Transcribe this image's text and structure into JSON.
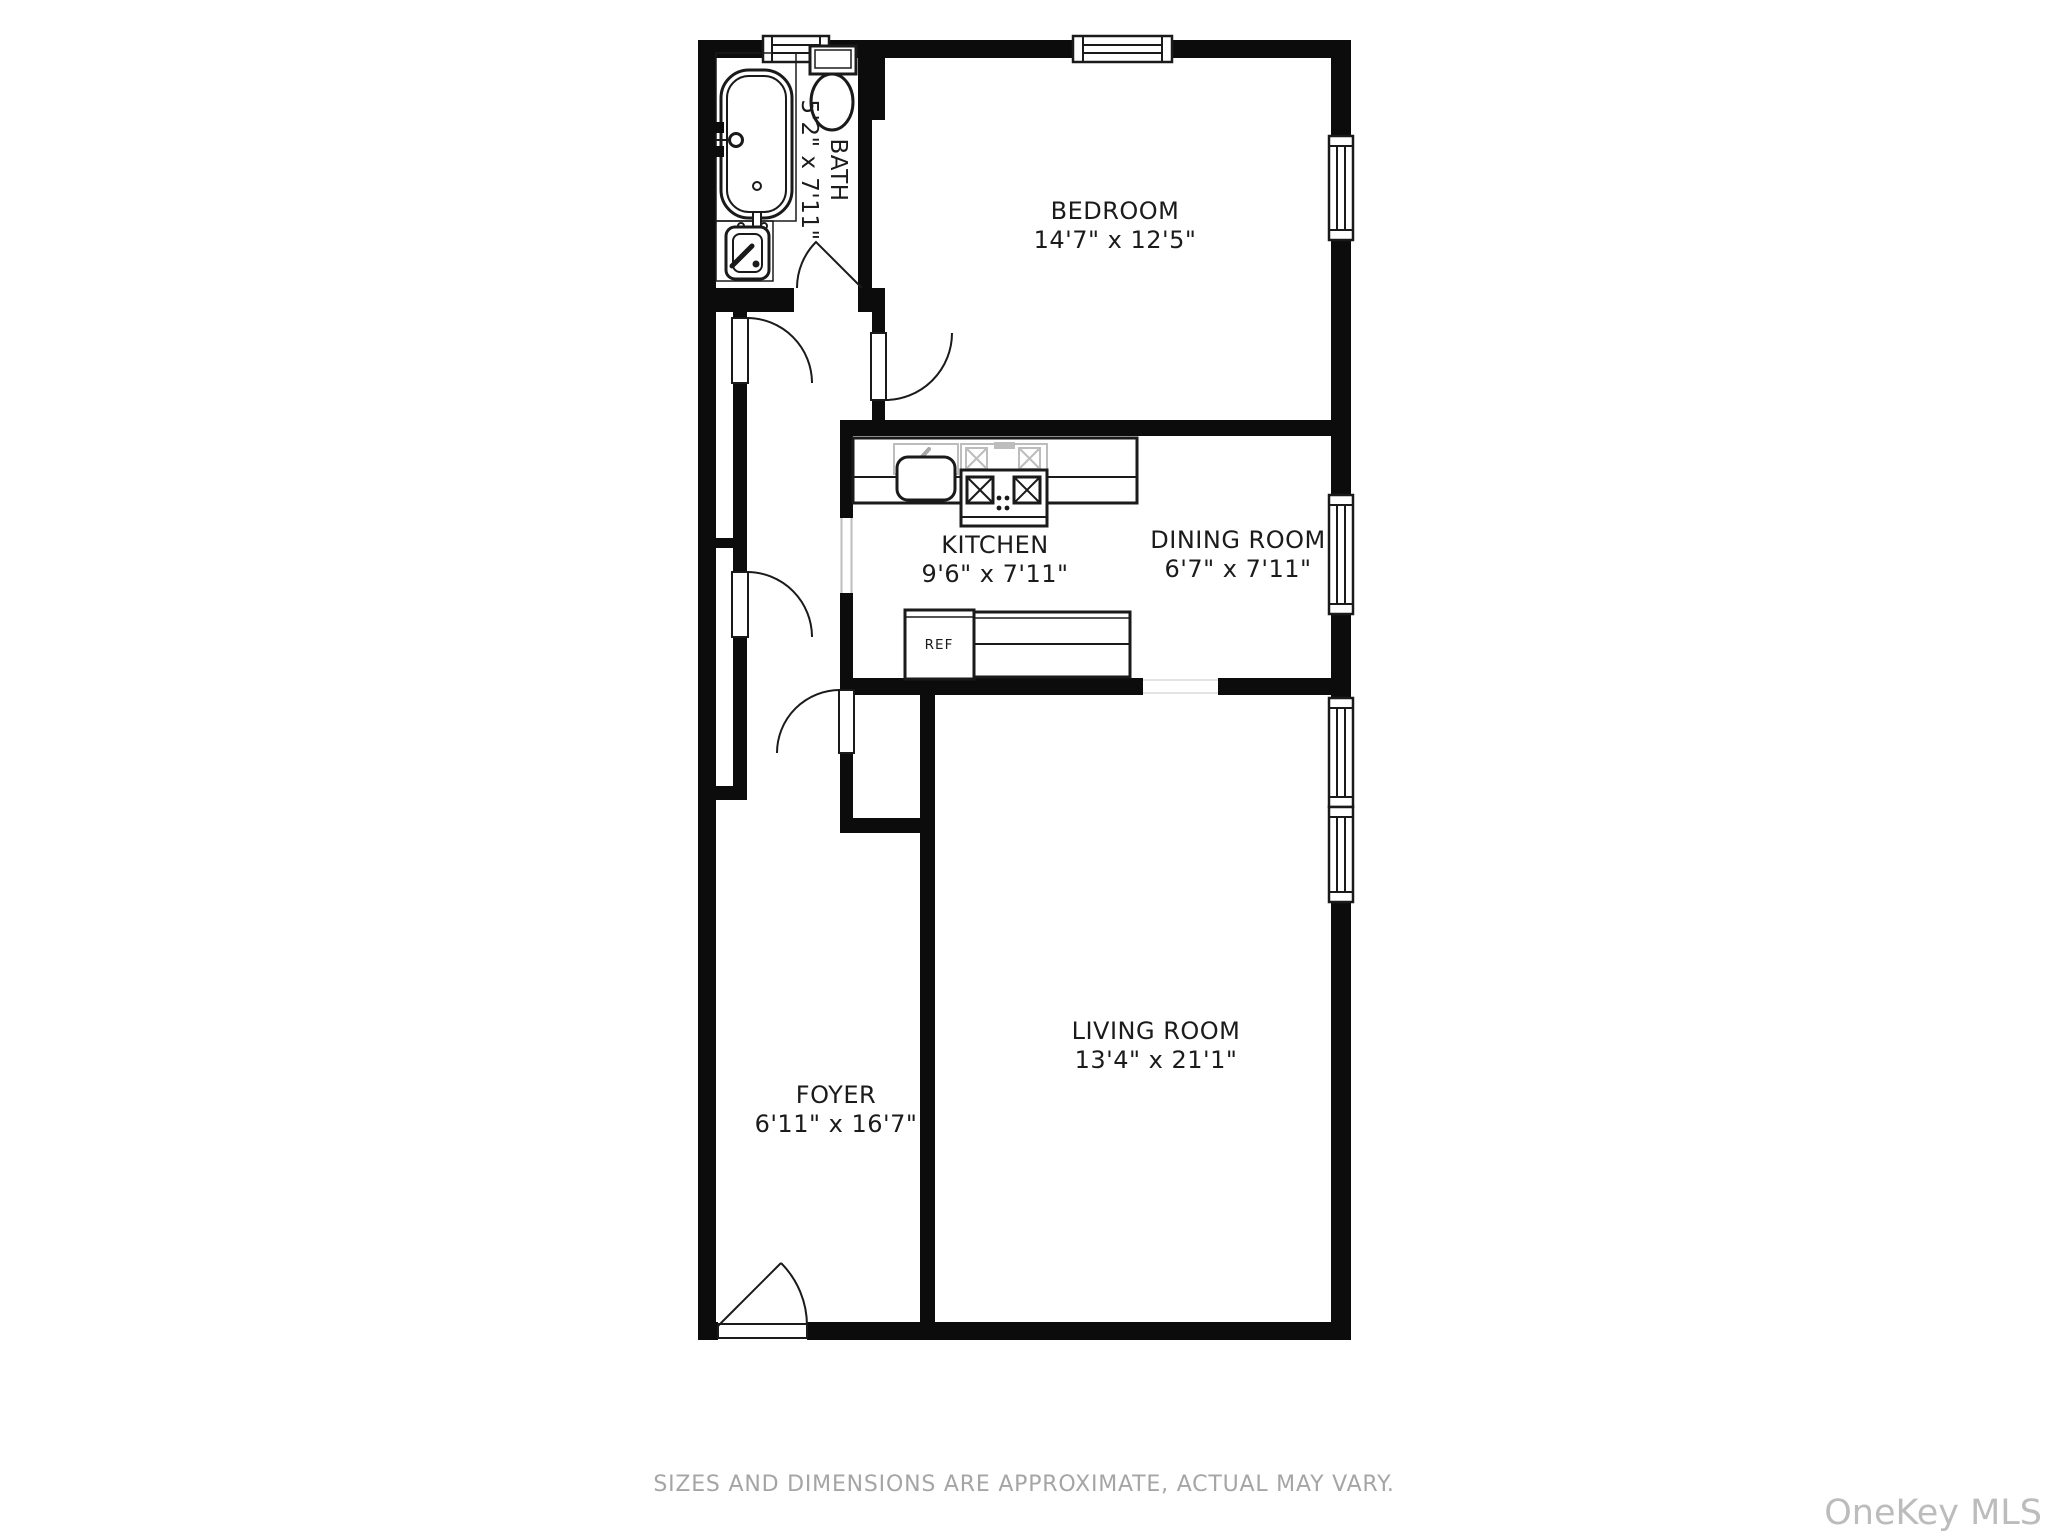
{
  "rooms": {
    "bath": {
      "name": "BATH",
      "dims": "5'2\" x 7'11\""
    },
    "bedroom": {
      "name": "BEDROOM",
      "dims": "14'7\" x 12'5\""
    },
    "kitchen": {
      "name": "KITCHEN",
      "dims": "9'6\" x 7'11\""
    },
    "dining_room": {
      "name": "DINING ROOM",
      "dims": "6'7\" x 7'11\""
    },
    "living_room": {
      "name": "LIVING ROOM",
      "dims": "13'4\" x 21'1\""
    },
    "foyer": {
      "name": "FOYER",
      "dims": "6'11\" x 16'7\""
    }
  },
  "fixtures": {
    "refrigerator_label": "REF"
  },
  "footer": {
    "disclaimer": "SIZES AND DIMENSIONS ARE APPROXIMATE, ACTUAL MAY VARY."
  },
  "watermark": {
    "text": "OneKey MLS"
  },
  "colors": {
    "wall": "#0c0c0c",
    "line": "#1a1a1a",
    "fixture-gray": "#bdbdbd",
    "footer-text": "#a5a5a5",
    "watermark-text": "#bcbcbc"
  }
}
